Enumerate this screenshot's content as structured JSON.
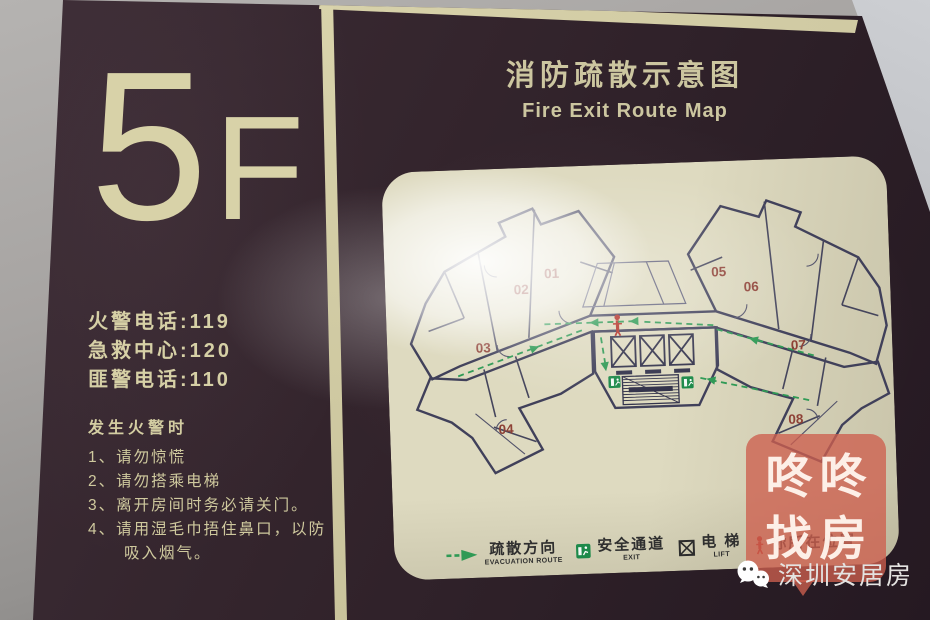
{
  "floor": {
    "number": "5",
    "suffix": "F"
  },
  "left_panel": {
    "emergency_lines": [
      "火警电话:119",
      "急救中心:120",
      "匪警电话:110"
    ],
    "fire_heading": "发生火警时",
    "instructions": [
      "1、请勿惊慌",
      "2、请勿搭乘电梯",
      "3、离开房间时务必请关门。",
      "4、请用湿毛巾捂住鼻口，以防吸入烟气。"
    ]
  },
  "header": {
    "title_cn": "消防疏散示意图",
    "title_en": "Fire Exit Route Map"
  },
  "map": {
    "units": [
      "01",
      "02",
      "03",
      "04",
      "05",
      "06",
      "07",
      "08"
    ],
    "legend": [
      {
        "cn": "疏散方向",
        "en": "EVACUATION ROUTE"
      },
      {
        "cn": "安全通道",
        "en": "EXIT"
      },
      {
        "cn": "电 梯",
        "en": "LIFT"
      },
      {
        "cn": "你所在位置",
        "en": ""
      }
    ]
  },
  "watermark": {
    "line1": "咚咚",
    "line2": "找房"
  },
  "footer": {
    "brand": "深圳安居房"
  },
  "colors": {
    "sign_brown": "#33242c",
    "cream": "#d7d1a8",
    "map_bg": "#dedac0",
    "plan_wall": "#40405a",
    "route_green": "#2f9a55",
    "unit_red": "#8e4136",
    "watermark_red": "#cd5f4e"
  }
}
